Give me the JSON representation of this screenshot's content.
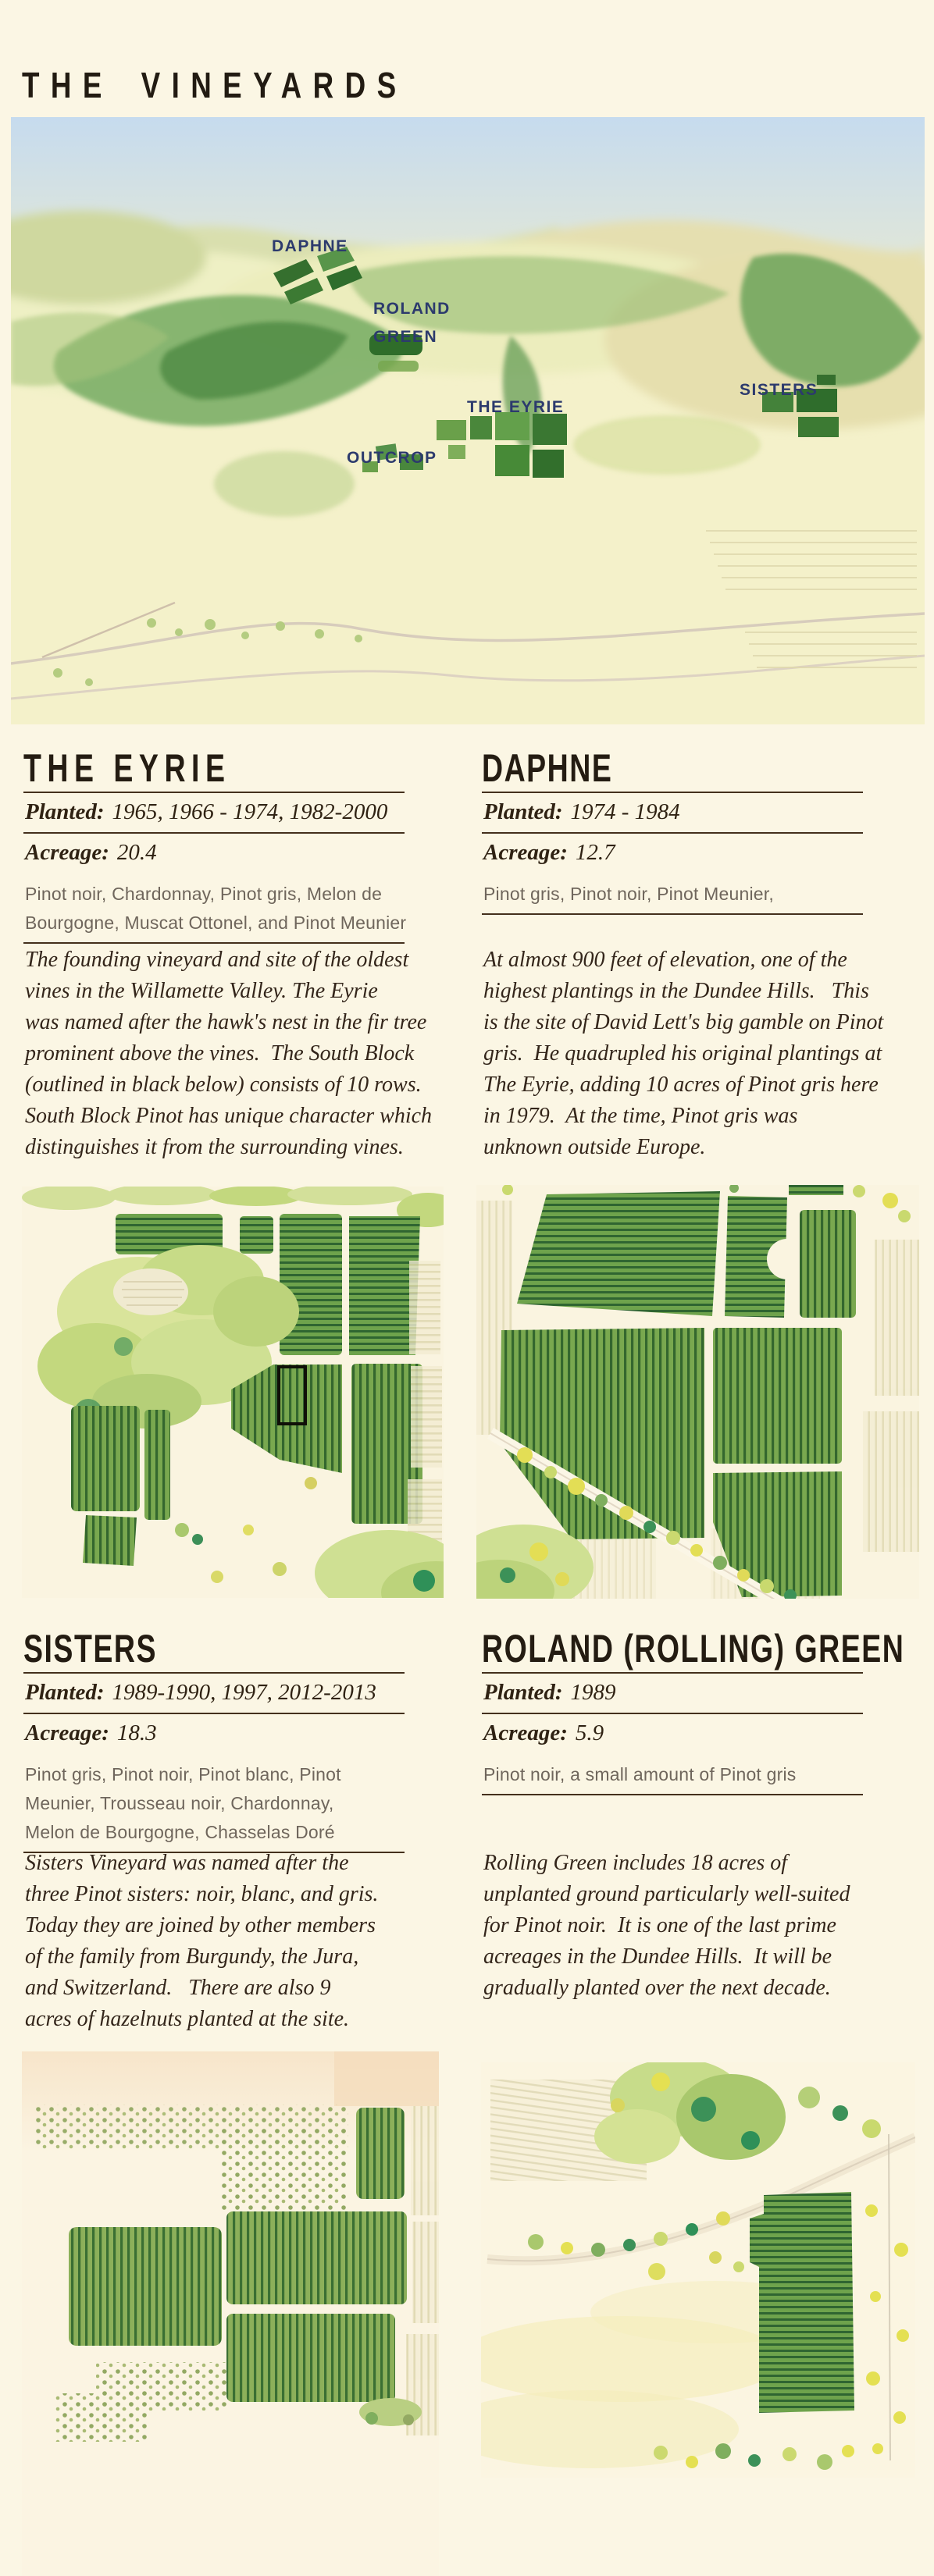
{
  "page": {
    "title": "THE VINEYARDS",
    "background": "#fbf6e4",
    "accent_navy": "#2c3a6d",
    "ink": "#2f2213"
  },
  "map": {
    "labels": {
      "daphne": "DAPHNE",
      "roland1": "ROLAND",
      "roland2": "GREEN",
      "eyrie": "THE EYRIE",
      "outcrop": "OUTCROP",
      "sisters": "SISTERS"
    }
  },
  "sections": {
    "eyrie": {
      "name": "THE EYRIE",
      "planted_label": "Planted:",
      "planted": "1965, 1966 - 1974, 1982-2000",
      "acreage_label": "Acreage:",
      "acreage": "20.4",
      "varietals": "Pinot noir, Chardonnay, Pinot gris, Melon de\nBourgogne, Muscat Ottonel, and Pinot Meunier",
      "description": "The founding vineyard and site of the oldest\nvines in the Willamette Valley. The Eyrie\nwas named after the hawk's nest in the fir tree\nprominent above the vines.  The South Block\n(outlined in black below) consists of 10 rows.\nSouth Block Pinot has unique character which\ndistinguishes it from the surrounding vines."
    },
    "daphne": {
      "name": "DAPHNE",
      "planted_label": "Planted:",
      "planted": "1974 - 1984",
      "acreage_label": "Acreage:",
      "acreage": "12.7",
      "varietals": "Pinot gris, Pinot noir, Pinot Meunier,",
      "description": "At almost 900 feet of elevation, one of the\nhighest plantings in the Dundee Hills.   This\nis the site of David Lett's big gamble on Pinot\ngris.  He quadrupled his original plantings at\nThe Eyrie, adding 10 acres of Pinot gris here\nin 1979.  At the time, Pinot gris was\nunknown outside Europe."
    },
    "sisters": {
      "name": "SISTERS",
      "planted_label": "Planted:",
      "planted": "1989-1990, 1997, 2012-2013",
      "acreage_label": "Acreage:",
      "acreage": "18.3",
      "varietals": "Pinot gris, Pinot noir, Pinot blanc, Pinot\nMeunier, Trousseau noir, Chardonnay,\nMelon de Bourgogne, Chasselas Doré",
      "description": "Sisters Vineyard was named after the\nthree Pinot sisters: noir, blanc, and gris.\nToday they are joined by other members\nof the family from Burgundy, the Jura,\nand Switzerland.   There are also 9\nacres of hazelnuts planted at the site."
    },
    "roland": {
      "name": "ROLAND (ROLLING) GREEN",
      "planted_label": "Planted:",
      "planted": "1989",
      "acreage_label": "Acreage:",
      "acreage": "5.9",
      "varietals": "Pinot noir, a small amount of Pinot gris",
      "description": "Rolling Green includes 18 acres of\nunplanted ground particularly well-suited\nfor Pinot noir.  It is one of the last prime\nacreages in the Dundee Hills.  It will be\ngradually planted over the next decade."
    }
  }
}
